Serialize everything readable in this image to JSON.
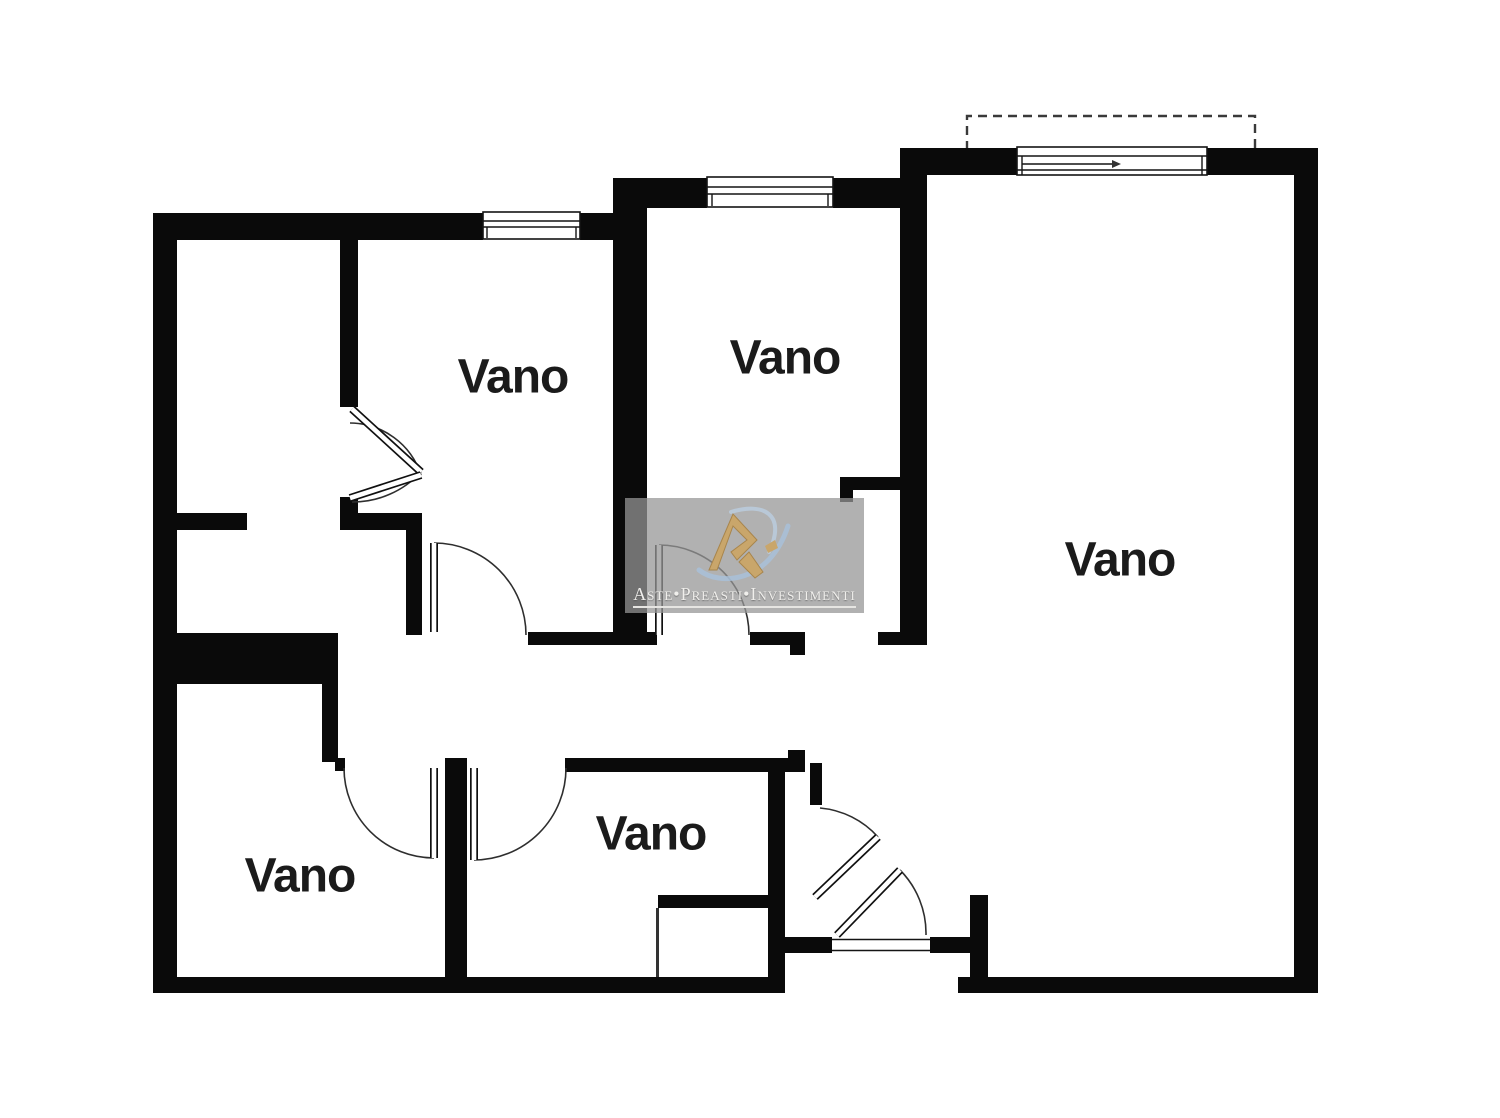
{
  "plan": {
    "type": "apartment-floor-plan",
    "room_labels": [
      {
        "id": "room-top-left",
        "label": "Vano"
      },
      {
        "id": "room-top-middle",
        "label": "Vano"
      },
      {
        "id": "room-right",
        "label": "Vano"
      },
      {
        "id": "room-bottom-left",
        "label": "Vano"
      },
      {
        "id": "room-bottom-middle",
        "label": "Vano"
      }
    ],
    "colors": {
      "wall": "#0a0a0a",
      "line": "#2e2e2e",
      "background": "#ffffff",
      "label_text": "#1b1b1b"
    }
  },
  "watermark": {
    "caption": "Aste•Preasti•Investimenti",
    "panel_color": "#969696",
    "logo": {
      "name": "ri-monogram",
      "gold": "#c9a66b",
      "gold_dark": "#a8854c",
      "swoosh": "#a9c2dc"
    }
  }
}
